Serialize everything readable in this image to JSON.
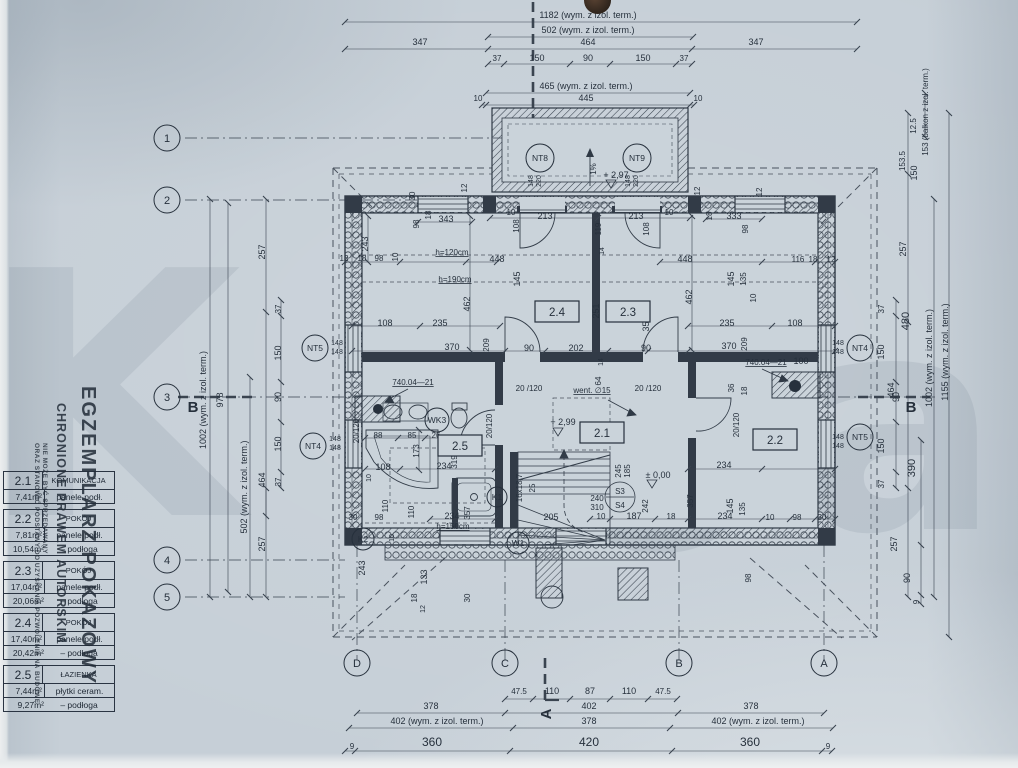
{
  "watermark": {
    "line1": "EGZEMPLARZ POKAZOWY",
    "line2": "CHRONIONE PRAWEM AUTORSKIM",
    "line3": "NIE MOŻE BYĆ SPRZEDAWANY",
    "line4": "ORAZ STANOWIĆ PODSTAWY DO UZYSKANIA POZWOLENIA NA BUDOWĘ",
    "big_letter_left": "K",
    "big_letter_mid": "o",
    "big_letter_right": "a"
  },
  "legend": {
    "rooms": [
      {
        "num": "2.1",
        "name": "KOMUNIKACJA",
        "area1": "7,41m²",
        "floor1": "panele podł.",
        "area2": "",
        "floor2": ""
      },
      {
        "num": "2.2",
        "name": "POKÓJ",
        "area1": "7,81m²",
        "floor1": "panele podł.",
        "area2": "10,54m²",
        "floor2": "–  podłoga"
      },
      {
        "num": "2.3",
        "name": "POKÓJ",
        "area1": "17,04m²",
        "floor1": "panele podł.",
        "area2": "20,06m²",
        "floor2": "–  podłoga"
      },
      {
        "num": "2.4",
        "name": "POKÓJ",
        "area1": "17,40m²",
        "floor1": "panele podł.",
        "area2": "20,42m²",
        "floor2": "–  podłoga"
      },
      {
        "num": "2.5",
        "name": "ŁAZIENKA",
        "area1": "7,44m²",
        "floor1": "płytki ceram.",
        "area2": "9,27m²",
        "floor2": "–  podłoga"
      }
    ]
  },
  "plan": {
    "grid": {
      "cols": [
        {
          "t": "D",
          "x": 357
        },
        {
          "t": "C",
          "x": 505
        },
        {
          "t": "B",
          "x": 679
        },
        {
          "t": "A",
          "x": 824
        }
      ],
      "rows": [
        {
          "t": "1",
          "y": 138
        },
        {
          "t": "2",
          "y": 200
        },
        {
          "t": "3",
          "y": 397
        },
        {
          "t": "4",
          "y": 560
        },
        {
          "t": "5",
          "y": 597
        }
      ]
    },
    "section_marks": [
      {
        "t": "B",
        "x": 193,
        "y": 412,
        "r": 0
      },
      {
        "t": "B",
        "x": 911,
        "y": 412,
        "r": 0
      },
      {
        "t": "A",
        "x": 551,
        "y": 714,
        "r": -90
      }
    ],
    "window_tags": [
      {
        "t": "NT8",
        "x": 540,
        "y": 158,
        "rad": 14
      },
      {
        "t": "NT9",
        "x": 637,
        "y": 158,
        "rad": 14
      },
      {
        "t": "NT5",
        "x": 315,
        "y": 348,
        "rad": 13
      },
      {
        "t": "NT4",
        "x": 313,
        "y": 446,
        "rad": 13
      },
      {
        "t": "NT4",
        "x": 860,
        "y": 348,
        "rad": 13
      },
      {
        "t": "NT5",
        "x": 860,
        "y": 437,
        "rad": 13
      },
      {
        "t": "WK3",
        "x": 437,
        "y": 420,
        "rad": 12
      },
      {
        "t": "K2",
        "x": 363,
        "y": 539,
        "rad": 11
      },
      {
        "t": "W1",
        "x": 518,
        "y": 543,
        "rad": 11
      },
      {
        "t": "K1",
        "x": 497,
        "y": 497,
        "rad": 10
      }
    ],
    "room_labels": [
      {
        "t": "2.4",
        "x": 557,
        "y": 312
      },
      {
        "t": "2.3",
        "x": 628,
        "y": 312
      },
      {
        "t": "2.1",
        "x": 602,
        "y": 433
      },
      {
        "t": "2.2",
        "x": 775,
        "y": 440
      },
      {
        "t": "2.5",
        "x": 460,
        "y": 446
      }
    ],
    "dim_label_format": [
      "text",
      "x",
      "y",
      "rotation",
      "fontSize",
      "underline"
    ],
    "dim_labels": [
      [
        "1182 (wym. z izol. term.)",
        588,
        18
      ],
      [
        "502 (wym. z izol. term.)",
        588,
        33
      ],
      [
        "347",
        420,
        45
      ],
      [
        "464",
        588,
        45
      ],
      [
        "347",
        756,
        45
      ],
      [
        "37",
        497,
        61,
        0,
        8
      ],
      [
        "150",
        537,
        61
      ],
      [
        "90",
        588,
        61
      ],
      [
        "150",
        643,
        61
      ],
      [
        "37",
        684,
        61,
        0,
        8
      ],
      [
        "465 (wym. z izol. term.)",
        586,
        89
      ],
      [
        "10",
        478,
        101,
        0,
        8
      ],
      [
        "445",
        586,
        101
      ],
      [
        "10",
        698,
        101,
        0,
        8
      ],
      [
        "47.5",
        519,
        694,
        0,
        8
      ],
      [
        "110",
        552,
        694
      ],
      [
        "87",
        590,
        694
      ],
      [
        "110",
        629,
        694
      ],
      [
        "47.5",
        663,
        694,
        0,
        8
      ],
      [
        "378",
        431,
        709
      ],
      [
        "402",
        589,
        709
      ],
      [
        "378",
        751,
        709
      ],
      [
        "402 (wym. z izol. term.)",
        437,
        724
      ],
      [
        "378",
        589,
        724
      ],
      [
        "402 (wym. z izol. term.)",
        758,
        724
      ],
      [
        "360",
        432,
        746,
        0,
        12
      ],
      [
        "420",
        589,
        746,
        0,
        12
      ],
      [
        "360",
        750,
        746,
        0,
        12
      ],
      [
        "9",
        352,
        749,
        0,
        8
      ],
      [
        "9",
        828,
        749,
        0,
        8
      ],
      [
        "1002 (wym. z izol. term.)",
        206,
        400,
        -90
      ],
      [
        "978",
        223,
        400,
        -90
      ],
      [
        "502 (wym. z izol. term.)",
        247,
        487,
        -90
      ],
      [
        "464",
        265,
        480,
        -90
      ],
      [
        "257",
        265,
        252,
        -90
      ],
      [
        "37",
        281,
        309,
        -90,
        8
      ],
      [
        "150",
        281,
        353,
        -90
      ],
      [
        "90",
        281,
        397,
        -90
      ],
      [
        "150",
        281,
        444,
        -90
      ],
      [
        "37",
        281,
        482,
        -90,
        8
      ],
      [
        "257",
        265,
        544,
        -90
      ],
      [
        "153 (balkon z izol. term.)",
        928,
        112,
        -90,
        8
      ],
      [
        "12.5",
        916,
        126,
        -90,
        8
      ],
      [
        "153.5",
        905,
        161,
        -90,
        8
      ],
      [
        "150",
        917,
        173,
        -90
      ],
      [
        "257",
        906,
        249,
        -90
      ],
      [
        "480",
        909,
        321,
        -90,
        11
      ],
      [
        "464",
        894,
        390,
        -90
      ],
      [
        "1002 (wym. z izol. term.)",
        932,
        358,
        -90
      ],
      [
        "1155 (wym. z izol. term.)",
        948,
        352,
        -90
      ],
      [
        "37",
        884,
        309,
        -90,
        8
      ],
      [
        "150",
        884,
        352,
        -90
      ],
      [
        "90",
        899,
        397,
        -90
      ],
      [
        "150",
        884,
        446,
        -90
      ],
      [
        "37",
        884,
        484,
        -90,
        8
      ],
      [
        "390",
        915,
        468,
        -90,
        11
      ],
      [
        "257",
        897,
        544,
        -90
      ],
      [
        "90",
        910,
        578,
        -90
      ],
      [
        "9",
        919,
        602,
        -90,
        8
      ],
      [
        "343",
        446,
        222
      ],
      [
        "98",
        419,
        224,
        -90,
        8
      ],
      [
        "30",
        415,
        196,
        -90,
        8
      ],
      [
        "18",
        431,
        215,
        -90,
        8
      ],
      [
        "12",
        467,
        188,
        -90,
        8
      ],
      [
        "243",
        368,
        244,
        -90
      ],
      [
        "12",
        344,
        261,
        0,
        8
      ],
      [
        "18",
        362,
        261,
        0,
        8
      ],
      [
        "98",
        379,
        261,
        0,
        8
      ],
      [
        "10",
        398,
        257,
        -90,
        8
      ],
      [
        "h=120cm",
        452,
        255,
        0,
        8,
        1
      ],
      [
        "448",
        497,
        262
      ],
      [
        "h=190cm",
        455,
        282,
        0,
        8,
        1
      ],
      [
        "145",
        520,
        279,
        -90
      ],
      [
        "462",
        470,
        304,
        -90
      ],
      [
        "108",
        385,
        326
      ],
      [
        "235",
        440,
        326
      ],
      [
        "370",
        452,
        350
      ],
      [
        "209",
        489,
        345,
        -90,
        8
      ],
      [
        "90",
        529,
        351
      ],
      [
        "202",
        576,
        351
      ],
      [
        "90",
        646,
        351
      ],
      [
        "213",
        545,
        219
      ],
      [
        "213",
        636,
        219
      ],
      [
        "10",
        511,
        215,
        0,
        8
      ],
      [
        "10",
        669,
        215,
        0,
        8
      ],
      [
        "108",
        519,
        226,
        -90,
        8
      ],
      [
        "119",
        601,
        229,
        -90,
        8
      ],
      [
        "108",
        649,
        229,
        -90,
        8
      ],
      [
        "14",
        604,
        251,
        -90,
        7
      ],
      [
        "251",
        599,
        311,
        -90
      ],
      [
        "354",
        649,
        324,
        -90
      ],
      [
        "64",
        601,
        381,
        -90,
        8
      ],
      [
        "14",
        603,
        362,
        -90,
        7
      ],
      [
        "+ 2,97",
        616,
        178
      ],
      [
        "1%",
        596,
        169,
        -90,
        8
      ],
      [
        "333",
        734,
        219
      ],
      [
        "98",
        748,
        229,
        -90,
        8
      ],
      [
        "18",
        712,
        216,
        -90,
        8
      ],
      [
        "12",
        700,
        191,
        -90,
        8
      ],
      [
        "12",
        762,
        192,
        -90,
        8
      ],
      [
        "448",
        685,
        262
      ],
      [
        "116",
        798,
        262,
        0,
        8
      ],
      [
        "18",
        813,
        262,
        0,
        8
      ],
      [
        "12",
        831,
        262,
        0,
        8
      ],
      [
        "145",
        734,
        279,
        -90
      ],
      [
        "135",
        746,
        279,
        -90,
        8
      ],
      [
        "10",
        756,
        298,
        -90,
        8
      ],
      [
        "462",
        692,
        297,
        -90
      ],
      [
        "235",
        727,
        326
      ],
      [
        "108",
        795,
        326
      ],
      [
        "370",
        729,
        349
      ],
      [
        "209",
        747,
        344,
        -90,
        8
      ],
      [
        "740.04—21",
        766,
        365,
        0,
        8,
        1
      ],
      [
        "100",
        801,
        364
      ],
      [
        "36",
        734,
        388,
        -90,
        8
      ],
      [
        "18",
        747,
        391,
        -90,
        8
      ],
      [
        "20 /120",
        529,
        391,
        0,
        8
      ],
      [
        "20 /120",
        648,
        391,
        0,
        8
      ],
      [
        "20/120",
        492,
        426,
        -90,
        8
      ],
      [
        "20/120",
        359,
        431,
        -90,
        8
      ],
      [
        "20/120",
        739,
        425,
        -90,
        8
      ],
      [
        "went. ∅15",
        592,
        393,
        0,
        8,
        1
      ],
      [
        "+ 2,99",
        563,
        425
      ],
      [
        "± 0,00",
        658,
        478
      ],
      [
        "16x18,7",
        522,
        488,
        -90,
        8
      ],
      [
        "25",
        535,
        488,
        -90,
        8
      ],
      [
        "205",
        551,
        520
      ],
      [
        "240",
        597,
        501,
        0,
        8
      ],
      [
        "310",
        597,
        510,
        0,
        8
      ],
      [
        "245",
        621,
        471,
        -90,
        8
      ],
      [
        "185",
        630,
        471,
        -90,
        8
      ],
      [
        "242",
        648,
        506,
        -90,
        8
      ],
      [
        "10",
        601,
        519,
        0,
        8
      ],
      [
        "187",
        634,
        519
      ],
      [
        "18",
        671,
        519,
        0,
        8
      ],
      [
        "234",
        725,
        519
      ],
      [
        "357",
        693,
        501,
        -90,
        8
      ],
      [
        "234",
        724,
        468
      ],
      [
        "145",
        733,
        506,
        -90
      ],
      [
        "135",
        745,
        509,
        -90,
        8
      ],
      [
        "10",
        770,
        520,
        0,
        8
      ],
      [
        "98",
        797,
        520,
        0,
        8
      ],
      [
        "30",
        822,
        520,
        0,
        8
      ],
      [
        "98",
        751,
        578,
        -90,
        8
      ],
      [
        "740.04—21",
        413,
        385,
        0,
        8,
        1
      ],
      [
        "85",
        412,
        438,
        0,
        8
      ],
      [
        "26",
        436,
        438,
        0,
        8
      ],
      [
        "88",
        378,
        438,
        0,
        8
      ],
      [
        "173",
        419,
        451,
        -90,
        8
      ],
      [
        "108",
        383,
        470
      ],
      [
        "234",
        444,
        469
      ],
      [
        "319",
        457,
        462,
        -90,
        8
      ],
      [
        "110",
        388,
        506,
        -90,
        8
      ],
      [
        "10",
        371,
        478,
        -90,
        7
      ],
      [
        "10",
        394,
        538,
        -90,
        7
      ],
      [
        "234",
        452,
        519
      ],
      [
        "h=150cm",
        453,
        529,
        0,
        8,
        1
      ],
      [
        "357",
        470,
        513,
        -90,
        8
      ],
      [
        "30",
        353,
        520,
        0,
        8
      ],
      [
        "98",
        379,
        520,
        0,
        8
      ],
      [
        "243",
        365,
        568,
        -90
      ],
      [
        "133",
        427,
        577,
        -90
      ],
      [
        "18",
        417,
        598,
        -90,
        8
      ],
      [
        "12",
        425,
        609,
        -90,
        7
      ],
      [
        "30",
        470,
        598,
        -90,
        8
      ],
      [
        "110",
        414,
        512,
        -90,
        8
      ],
      [
        "S3",
        620,
        494,
        0,
        8
      ],
      [
        "S4",
        620,
        508,
        0,
        8
      ],
      [
        "148",
        533,
        181,
        -90,
        7
      ],
      [
        "220",
        541,
        181,
        -90,
        7
      ],
      [
        "148",
        630,
        181,
        -90,
        7
      ],
      [
        "220",
        638,
        181,
        -90,
        7
      ],
      [
        "148",
        337,
        345,
        0,
        7
      ],
      [
        "148",
        337,
        354,
        0,
        7
      ],
      [
        "148",
        335,
        441,
        0,
        7
      ],
      [
        "148",
        335,
        450,
        0,
        7
      ],
      [
        "148",
        838,
        345,
        0,
        7
      ],
      [
        "148",
        838,
        354,
        0,
        7
      ],
      [
        "148",
        838,
        439,
        0,
        7
      ],
      [
        "148",
        838,
        448,
        0,
        7
      ]
    ]
  }
}
